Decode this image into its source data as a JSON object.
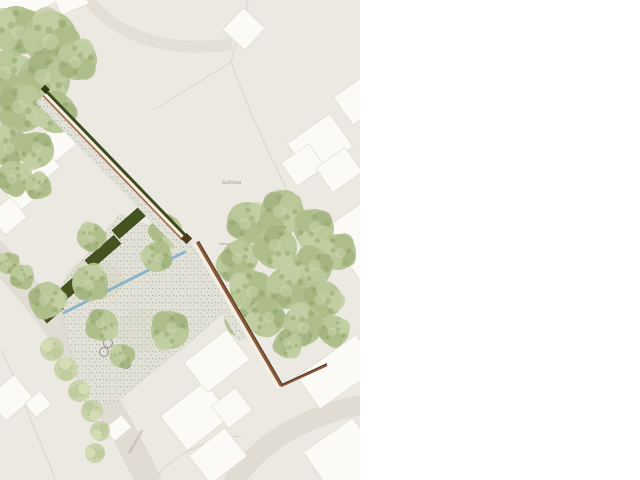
{
  "map": {
    "type": "landscape-site-plan",
    "labels": {
      "schloss": "Schloss",
      "area_small": "Wiese",
      "street": "Wilhelmstraße"
    },
    "palette": {
      "canvas": "#ece8e2",
      "road": "#e1dcd3",
      "building": "#fbfaf6",
      "building_outline": "#ded8cc",
      "tree_green": "#b5c494",
      "tree_pale": "#c8d3a9",
      "hedge_dark": "#45531e",
      "paving_base": "#e3e2d9",
      "paving_dot": "#b6b7ac",
      "path_cream": "#f4efe2",
      "path_brown": "#a26b4a",
      "wall_brown": "#8a5a38",
      "wall_dark": "#4a3018",
      "hedge_line_green": "#3c4b1c",
      "water_blue": "#8fb6cf",
      "parcel_line": "#d9d2c6",
      "label_text": "#9c9489"
    }
  }
}
